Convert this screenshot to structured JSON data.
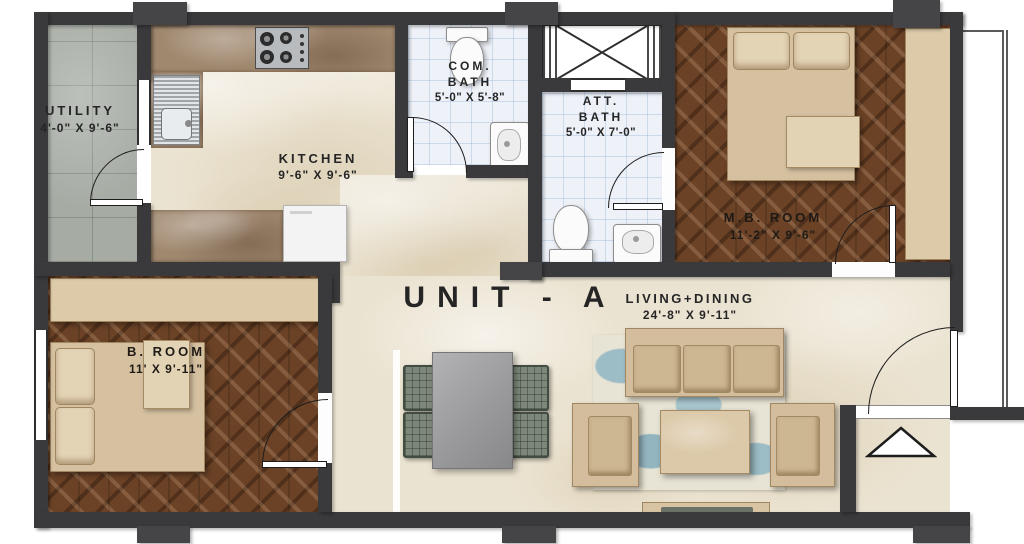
{
  "plan": {
    "unit_label": "UNIT - A",
    "rooms": {
      "utility": {
        "name": "UTILITY",
        "dims": "4'-0\" X 9'-6\""
      },
      "kitchen": {
        "name": "KITCHEN",
        "dims": "9'-6\" X 9'-6\""
      },
      "com_bath": {
        "line1": "COM.",
        "line2": "BATH",
        "dims": "5'-0\" X 5'-8\""
      },
      "att_bath": {
        "line1": "ATT.",
        "line2": "BATH",
        "dims": "5'-0\" X 7'-0\""
      },
      "mb_room": {
        "name": "M.B. ROOM",
        "dims": "11'-2\" X 9'-6\""
      },
      "b_room": {
        "name": "B. ROOM",
        "dims": "11' X 9'-11\""
      },
      "living_dining": {
        "name": "LIVING+DINING",
        "dims": "24'-8\" X 9'-11\""
      }
    },
    "colors": {
      "wall": "#3a393b",
      "wood_floor": "#6b4226",
      "marble_floor": "#ebe3d1",
      "counter_marble": "#a0886f",
      "bath_tile": "#eef2f8",
      "utility_tile": "#a6aba4",
      "furniture_beige": "#d8c4a3",
      "rug_blue": "#9cbcc6",
      "chair_green": "#7e887a",
      "text": "#252525"
    }
  }
}
